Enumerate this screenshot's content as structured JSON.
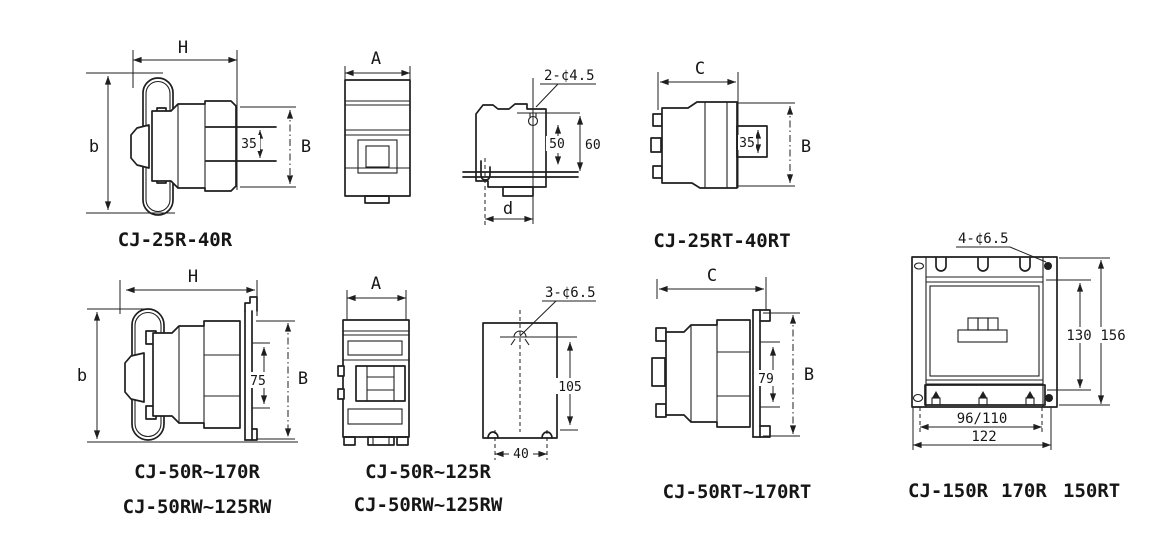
{
  "figure": {
    "background": "#ffffff",
    "line_color": "#1f1f1f",
    "drawings": [
      {
        "name": "cj25r-side",
        "caption": "CJ-25R-40R",
        "dims": {
          "width": "H",
          "height": "b",
          "rail": "35",
          "depth": "B"
        }
      },
      {
        "name": "cj25r-front",
        "dims": {
          "width": "A"
        }
      },
      {
        "name": "cj25r-mounting",
        "dims": {
          "holes": "2-¢4.5",
          "hole_span": "50",
          "total_height": "60",
          "foot": "d"
        }
      },
      {
        "name": "cj25rt-side",
        "caption": "CJ-25RT-40RT",
        "dims": {
          "width": "C",
          "rail": "35",
          "depth": "B"
        }
      },
      {
        "name": "cj50r-side",
        "caption_line1": "CJ-50R~170R",
        "caption_line2": "CJ-50RW~125RW",
        "dims": {
          "width": "H",
          "height": "b",
          "rail": "75",
          "depth": "B"
        }
      },
      {
        "name": "cj50r-front",
        "caption_line1": "CJ-50R~125R",
        "caption_line2": "CJ-50RW~125RW",
        "dims": {
          "width": "A"
        }
      },
      {
        "name": "cj50r-mounting",
        "dims": {
          "holes": "3-¢6.5",
          "hole_span": "105",
          "foot": "40"
        }
      },
      {
        "name": "cj50rt-side",
        "caption": "CJ-50RT~170RT",
        "dims": {
          "width": "C",
          "rail": "79",
          "depth": "B"
        }
      },
      {
        "name": "cj150-front",
        "caption_parts": [
          "CJ-150R",
          "170R",
          "150RT"
        ],
        "dims": {
          "holes": "4-¢6.5",
          "inner_height": "130",
          "outer_height": "156",
          "inner_width": "96/110",
          "outer_width": "122"
        }
      }
    ]
  }
}
